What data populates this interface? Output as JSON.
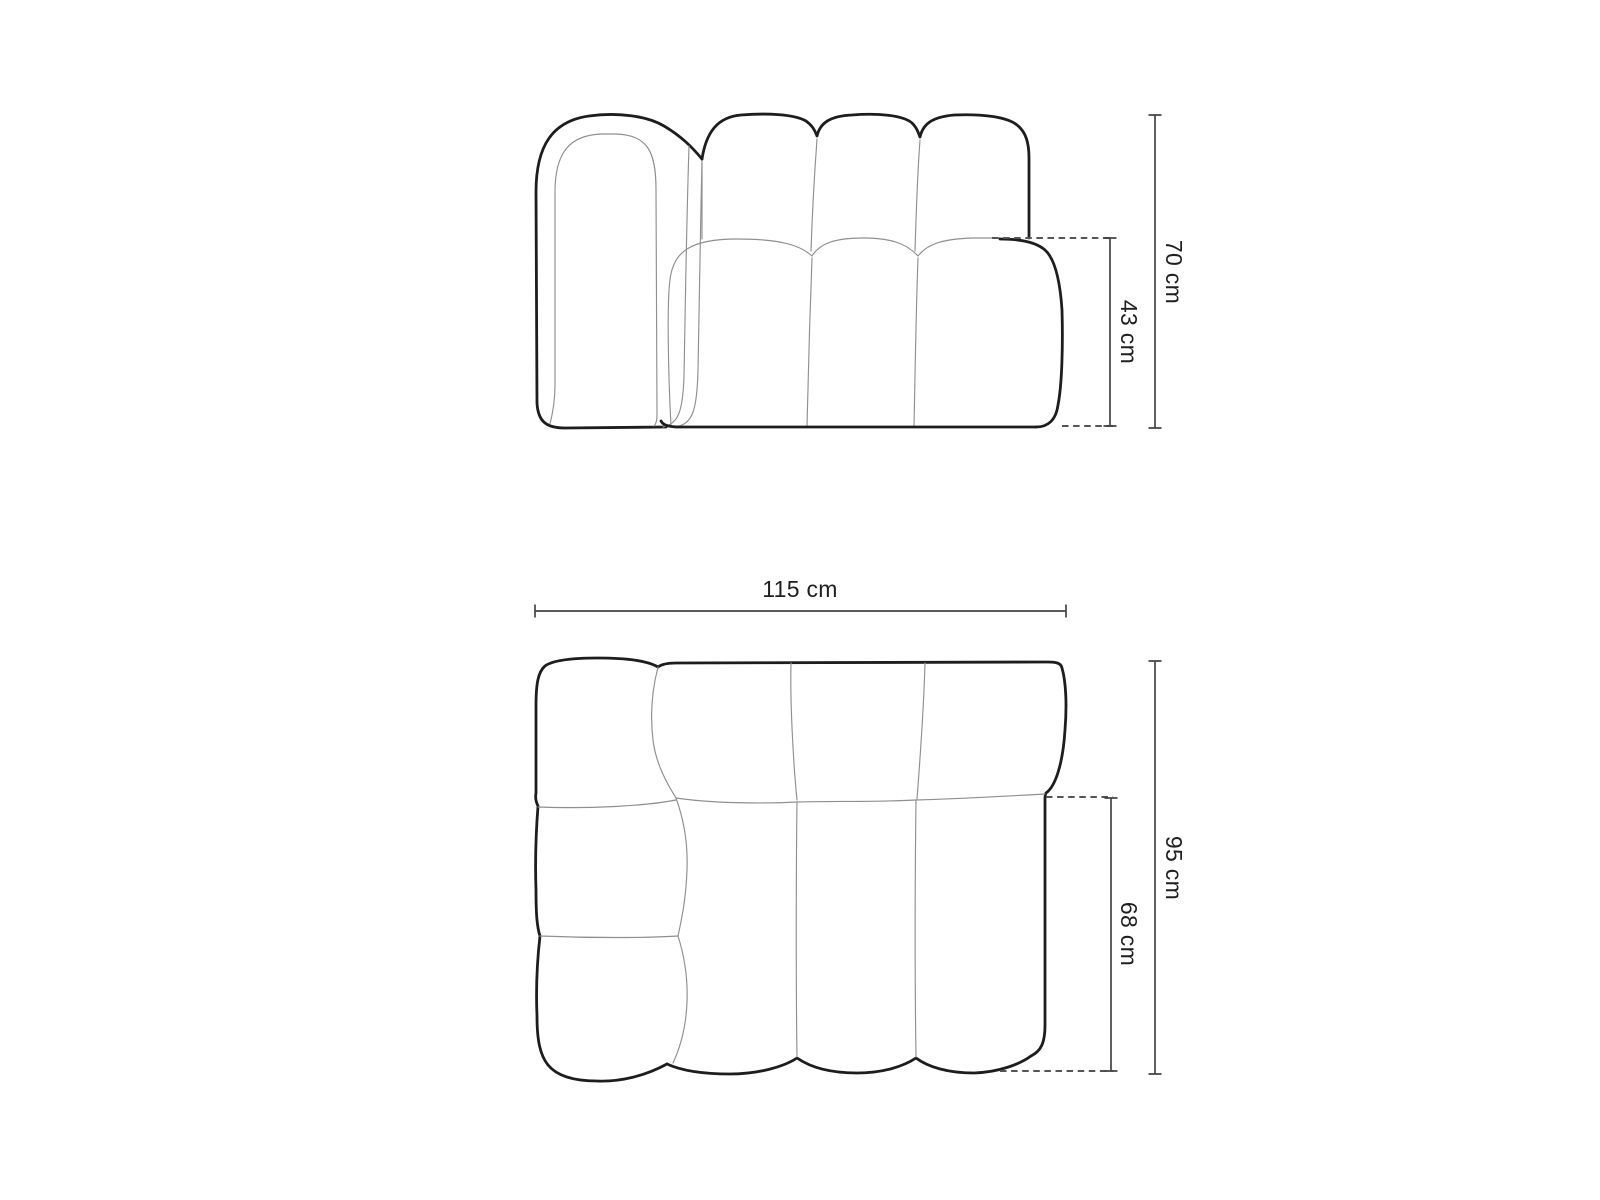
{
  "diagram": {
    "front_view": {
      "dims": {
        "total_height": "70 cm",
        "seat_height": "43 cm"
      }
    },
    "top_view": {
      "dims": {
        "total_width": "115 cm",
        "total_depth": "95 cm",
        "seat_depth": "68 cm"
      }
    },
    "colors": {
      "outline": "#1d1d1d",
      "seam": "#8f8f8f",
      "dimension_line": "#444444",
      "dashed_line": "#555555",
      "label_text": "#1f1f1f",
      "page_bg": "#ffffff"
    }
  }
}
